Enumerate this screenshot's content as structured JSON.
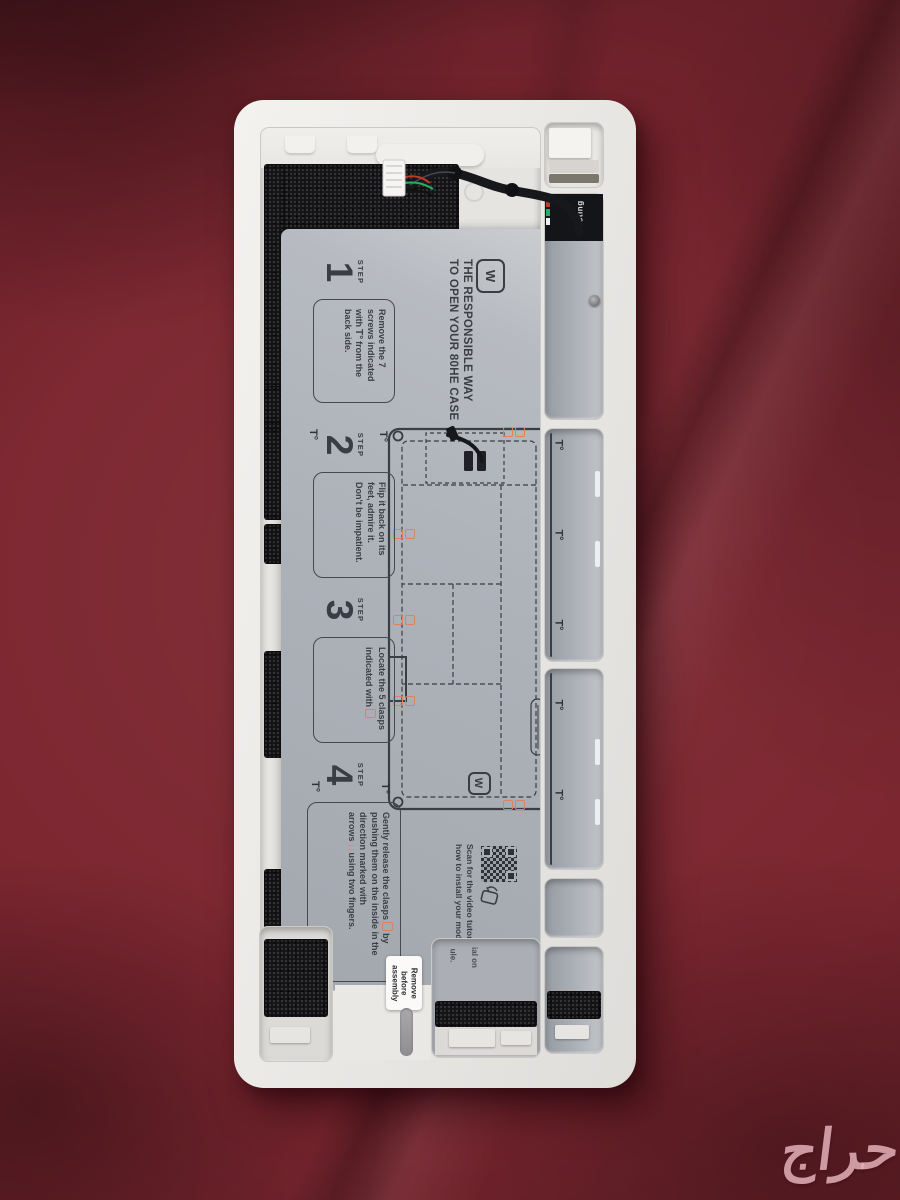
{
  "watermark": {
    "text": "حراج",
    "color": "#e0adb4"
  },
  "sheet": {
    "logo_glyph": "W",
    "heading_line1": "THE RESPONSIBLE WAY",
    "heading_line2": "TO OPEN YOUR 80HE CASE",
    "steps": [
      {
        "label": "STEP",
        "number": "1",
        "t1": "Remove the 7 screws indicated with",
        "t2": "from the back side."
      },
      {
        "label": "STEP",
        "number": "2",
        "text": "Flip it back on its feet, admire it. Don't be impatient."
      },
      {
        "label": "STEP",
        "number": "3",
        "t1": "Locate the 5 clasps",
        "t2": "indicated with"
      },
      {
        "label": "STEP",
        "number": "4",
        "t1": "Gently release the clasps",
        "t2": "by pushing them on the inside in the direction marked with arrows",
        "t3": "using two fingers."
      }
    ],
    "scan": {
      "line1": "Scan for the video tutorial on",
      "line2": "how to install your module."
    }
  },
  "symbols": {
    "torx": "T°",
    "arrows": "↓↓",
    "logo": "W"
  },
  "remove_tab": {
    "line1": "Remove",
    "line2": "before",
    "line3": "assembly"
  },
  "module_text": "wooting",
  "slot_fragments": {
    "f1": "ial on",
    "f2": "ule."
  },
  "colors": {
    "fabric_red": "#7c2630",
    "case_white": "#edebe8",
    "sheet_gray": "#adb2b9",
    "clasp_orange": "#dd8160",
    "foam_black": "#141417",
    "watermark_pink": "#e0adb4"
  }
}
